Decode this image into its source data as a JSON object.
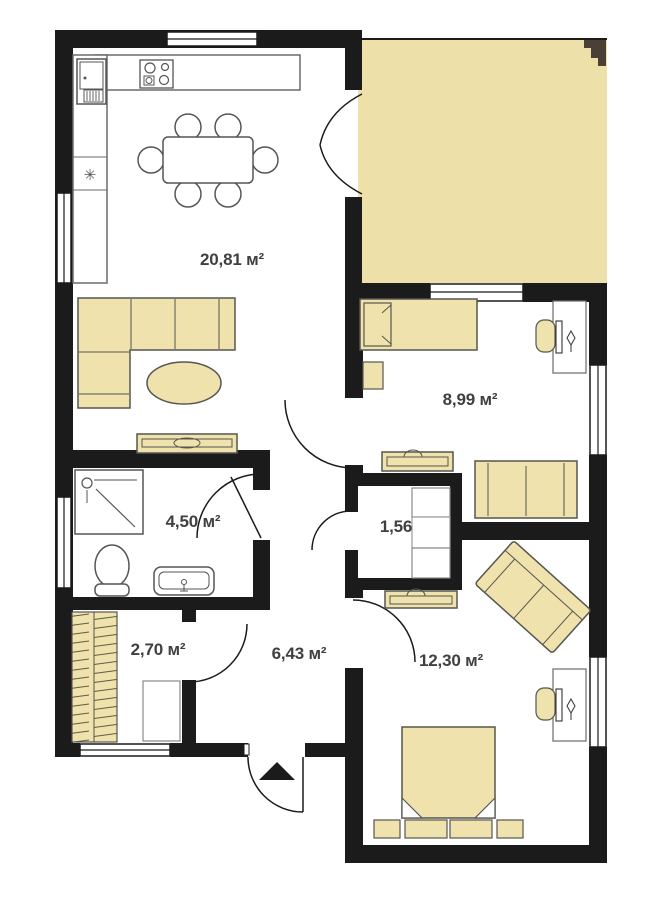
{
  "plan": {
    "title": "apartment-floor-plan",
    "rooms": [
      {
        "id": "living-kitchen",
        "area": "20,81 м²"
      },
      {
        "id": "bedroom-1",
        "area": "8,99 м²"
      },
      {
        "id": "bathroom",
        "area": "4,50 м²"
      },
      {
        "id": "closet",
        "area": "1,56"
      },
      {
        "id": "wardrobe",
        "area": "2,70 м²"
      },
      {
        "id": "hallway",
        "area": "6,43 м²"
      },
      {
        "id": "bedroom-2",
        "area": "12,30 м²"
      }
    ],
    "icons": {
      "freezer": "✳"
    },
    "colors": {
      "wall": "#1b1b1b",
      "terrace_fill": "#ede0a8",
      "furniture_fill": "#f0e2ad",
      "furniture_stroke": "#55564f",
      "label": "#3f4041",
      "north_marker": "#4a4036"
    }
  }
}
